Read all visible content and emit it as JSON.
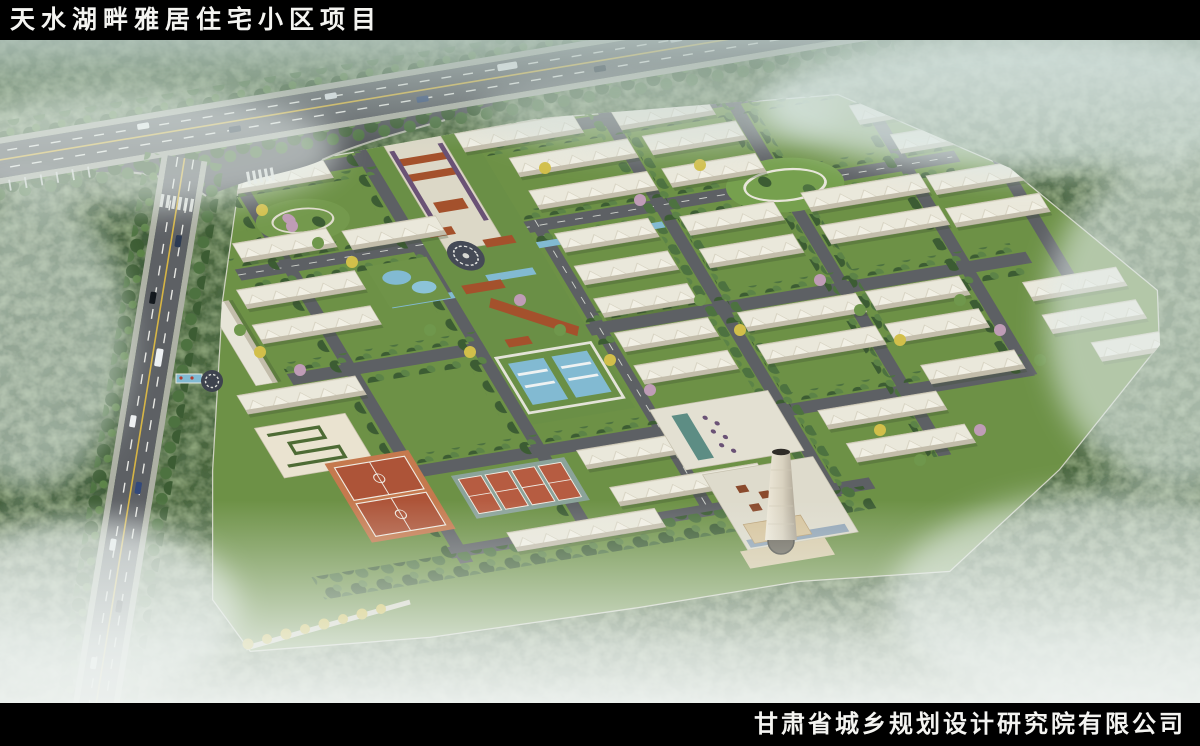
{
  "header": {
    "title": "天水湖畔雅居住宅小区项目"
  },
  "footer": {
    "company": "甘肃省城乡规划设计研究院有限公司"
  },
  "scene": {
    "type": "aerial-masterplan-rendering",
    "features": [
      "residential-building-rows",
      "central-landscape-axis",
      "circular-plaza",
      "water-pools",
      "basketball-courts",
      "tennis-courts",
      "commercial-complex",
      "chimney-tower",
      "north-arterial-road",
      "west-arterial-road",
      "intersection-plaza",
      "forest",
      "mist"
    ],
    "palette": {
      "road": "#5d6064",
      "plaza": "#53565a",
      "road_marking_yellow": "#d7b544",
      "building": "#e9e7da",
      "lawn": "#6d9146",
      "water": "#82bad2",
      "pavilion": "#a4512c",
      "basketball_court": "#ad5438",
      "basketball_apron": "#c5794e",
      "tennis_court": "#b65c41",
      "tennis_apron": "#8ba39a",
      "forest": "#466339",
      "forest_dark": "#33502c",
      "mist": "#e6efec",
      "commercial_tan": "#d7c49c",
      "autumn_tree": "#d2bf4a",
      "blossom_tree": "#bf9cb6"
    }
  }
}
